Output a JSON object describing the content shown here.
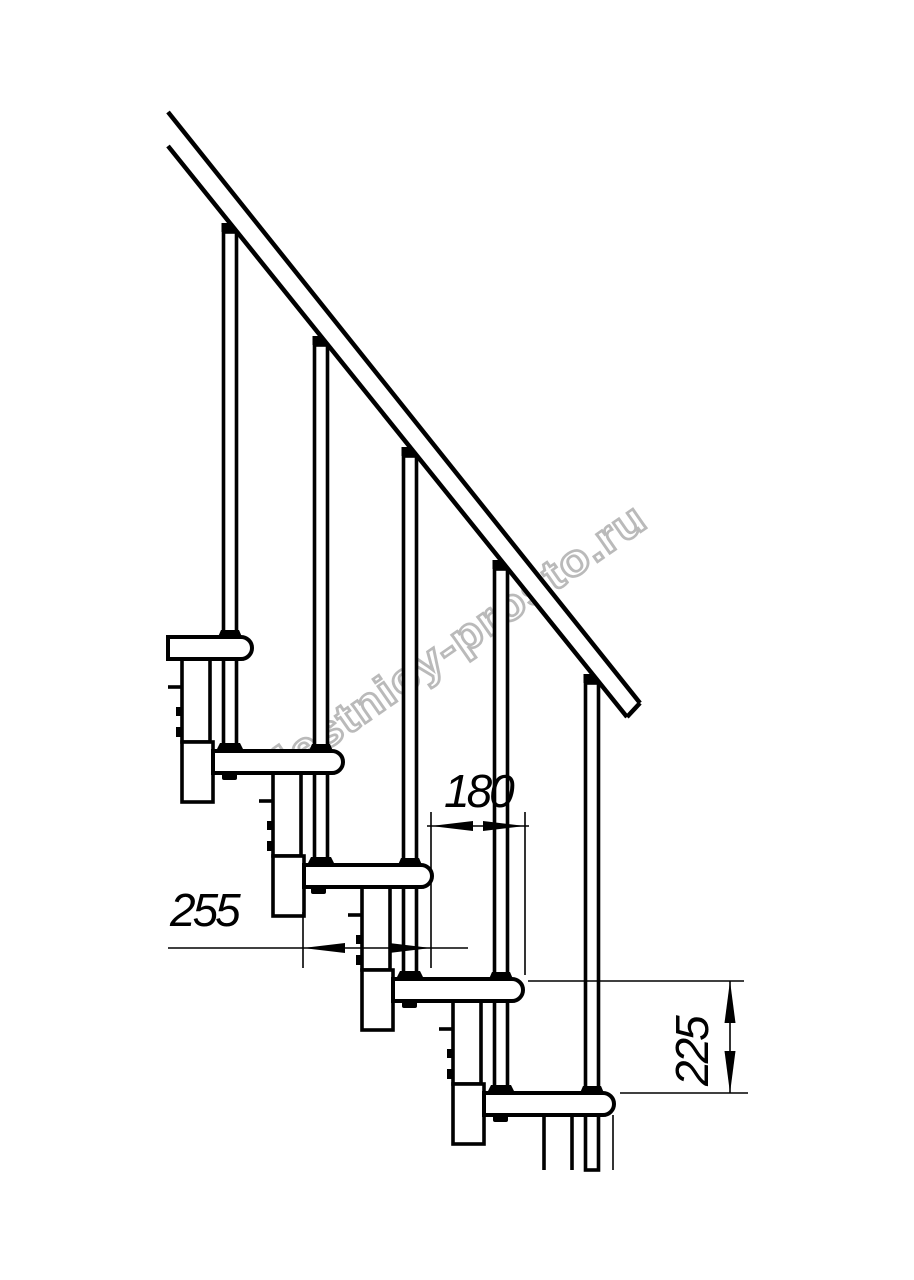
{
  "watermark": {
    "text": "lestnicy-prosto.ru",
    "color": "#b3b3b3"
  },
  "dimensions": {
    "step_run": "180",
    "tread_depth": "255",
    "step_rise": "225"
  },
  "colors": {
    "line": "#000000",
    "background": "#ffffff"
  }
}
